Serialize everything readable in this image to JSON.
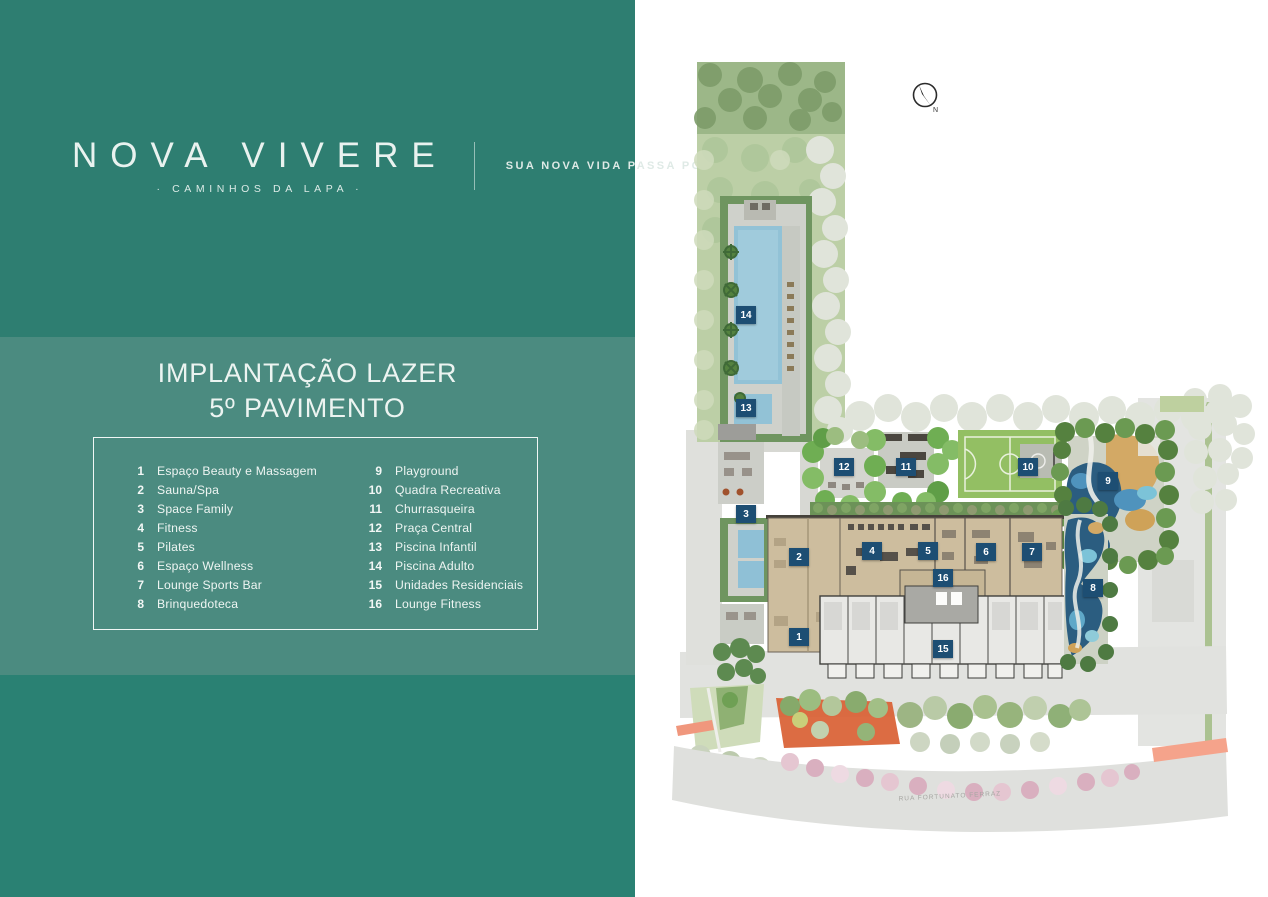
{
  "brand": {
    "name": "NOVA VIVERE",
    "sub": "· CAMINHOS DA LAPA ·",
    "tagline": "SUA NOVA VIDA PASSA POR AQUI"
  },
  "title": {
    "line1": "IMPLANTAÇÃO LAZER",
    "line2": "5º PAVIMENTO"
  },
  "legend": {
    "items": [
      {
        "n": "1",
        "label": "Espaço Beauty e Massagem"
      },
      {
        "n": "2",
        "label": "Sauna/Spa"
      },
      {
        "n": "3",
        "label": "Space Family"
      },
      {
        "n": "4",
        "label": "Fitness"
      },
      {
        "n": "5",
        "label": "Pilates"
      },
      {
        "n": "6",
        "label": "Espaço Wellness"
      },
      {
        "n": "7",
        "label": "Lounge Sports Bar"
      },
      {
        "n": "8",
        "label": "Brinquedoteca"
      },
      {
        "n": "9",
        "label": "Playground"
      },
      {
        "n": "10",
        "label": "Quadra Recreativa"
      },
      {
        "n": "11",
        "label": "Churrasqueira"
      },
      {
        "n": "12",
        "label": "Praça Central"
      },
      {
        "n": "13",
        "label": "Piscina Infantil"
      },
      {
        "n": "14",
        "label": "Piscina Adulto"
      },
      {
        "n": "15",
        "label": "Unidades Residenciais"
      },
      {
        "n": "16",
        "label": "Lounge Fitness"
      }
    ]
  },
  "plan": {
    "street_label": "RUA FORTUNATO FERRAZ",
    "compass_label": "N",
    "markers": [
      {
        "n": "1",
        "x": 139,
        "y": 637
      },
      {
        "n": "2",
        "x": 139,
        "y": 557
      },
      {
        "n": "3",
        "x": 86,
        "y": 514
      },
      {
        "n": "4",
        "x": 212,
        "y": 551
      },
      {
        "n": "5",
        "x": 268,
        "y": 551
      },
      {
        "n": "6",
        "x": 326,
        "y": 552
      },
      {
        "n": "7",
        "x": 372,
        "y": 552
      },
      {
        "n": "8",
        "x": 433,
        "y": 588
      },
      {
        "n": "9",
        "x": 448,
        "y": 481
      },
      {
        "n": "10",
        "x": 368,
        "y": 467
      },
      {
        "n": "11",
        "x": 246,
        "y": 467
      },
      {
        "n": "12",
        "x": 184,
        "y": 467
      },
      {
        "n": "13",
        "x": 86,
        "y": 408
      },
      {
        "n": "14",
        "x": 86,
        "y": 315
      },
      {
        "n": "15",
        "x": 283,
        "y": 649
      },
      {
        "n": "16",
        "x": 283,
        "y": 578
      }
    ]
  },
  "colors": {
    "teal_dark": "#2e7e71",
    "teal_mid": "#4b8b80",
    "teal_deep": "#2a8173",
    "marker_navy": "#1d4e73",
    "pool_blue": "#92c2d6",
    "play_navy": "#2b5d80",
    "court_green": "#93bf63"
  }
}
